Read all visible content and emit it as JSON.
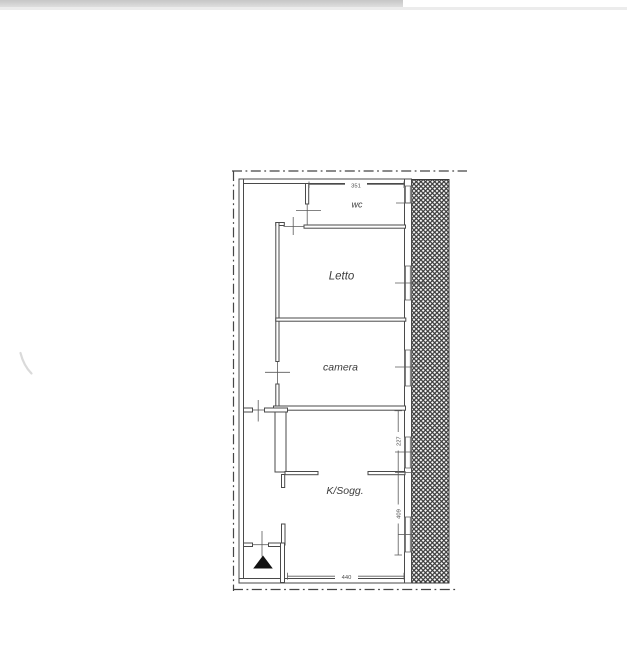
{
  "window": {
    "topbar": {
      "bar_color": "#c6c6c6",
      "divider_color": "#ececec"
    }
  },
  "plan": {
    "rooms": [
      {
        "name": "wc",
        "label": "wc"
      },
      {
        "name": "letto",
        "label": "Letto"
      },
      {
        "name": "camera",
        "label": "camera"
      },
      {
        "name": "ksogg",
        "label": "K/Sogg."
      }
    ],
    "dimensions": {
      "top_width": "351",
      "right_upper": "227",
      "right_lower": "409",
      "bottom_width": "440"
    },
    "colors": {
      "wall_line": "#4a4a4a",
      "thin_line": "#5a5a5a",
      "hatch_line": "#3a3a3a",
      "entrance_marker": "#111111"
    }
  }
}
